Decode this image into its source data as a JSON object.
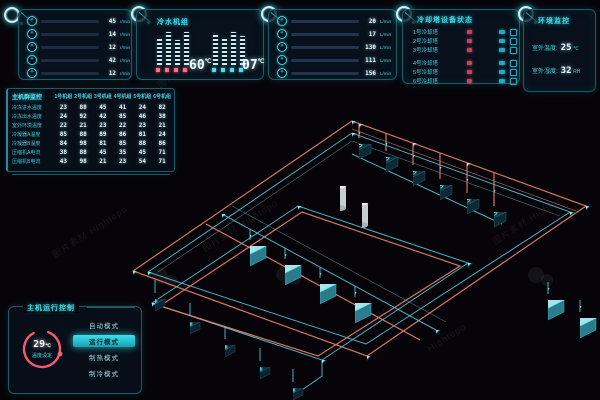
{
  "panels": {
    "pump_metrics": {
      "icon": "fan-icon",
      "rows": [
        {
          "value": "45",
          "unit": "r/min",
          "pct": 82
        },
        {
          "value": "14",
          "unit": "r/min",
          "pct": 60
        },
        {
          "value": "12",
          "unit": "r/min",
          "pct": 26
        },
        {
          "value": "42",
          "unit": "r/min",
          "pct": 63
        },
        {
          "value": "12",
          "unit": "r/min",
          "pct": 35
        }
      ]
    },
    "chilled_water": {
      "title": "冷水机组",
      "left": {
        "value": "60",
        "unit": "℃"
      },
      "right": {
        "value": "07",
        "unit": "℃"
      }
    },
    "flow_metrics": {
      "icon": "fan-icon",
      "rows": [
        {
          "value": "20",
          "unit": "L/min",
          "pct": 10
        },
        {
          "value": "17",
          "unit": "L/min",
          "pct": 13
        },
        {
          "value": "130",
          "unit": "L/min",
          "pct": 62
        },
        {
          "value": "111",
          "unit": "L/min",
          "pct": 52
        },
        {
          "value": "156",
          "unit": "L/min",
          "pct": 75
        }
      ]
    },
    "cooling_tower_status": {
      "title": "冷却塔设备状态",
      "rows": [
        {
          "label": "1号冷却塔"
        },
        {
          "label": "2号冷却塔"
        },
        {
          "label": "3号冷却塔"
        },
        {
          "label": "4号冷却塔"
        },
        {
          "label": "5号冷却塔"
        },
        {
          "label": "6号冷却塔"
        }
      ]
    },
    "environment": {
      "title": "环境监控",
      "rows": [
        {
          "label": "室外温度:",
          "value": "25",
          "unit": "℃"
        },
        {
          "label": "室外湿度:",
          "value": "32",
          "unit": "RH"
        }
      ]
    }
  },
  "host_table": {
    "title": "主机群监控",
    "columns": [
      "1号机组",
      "2号机组",
      "3号机组",
      "4号机组",
      "5号机组",
      "6号机组"
    ],
    "rows": [
      {
        "label": "冷冻进水温度",
        "values": [
          "23",
          "88",
          "45",
          "41",
          "24",
          "82"
        ]
      },
      {
        "label": "冷冻出水温度",
        "values": [
          "24",
          "92",
          "42",
          "85",
          "46",
          "38"
        ]
      },
      {
        "label": "室外环境温度",
        "values": [
          "22",
          "21",
          "23",
          "22",
          "23",
          "21"
        ]
      },
      {
        "label": "冷凝器A温度",
        "values": [
          "85",
          "88",
          "89",
          "86",
          "81",
          "24"
        ]
      },
      {
        "label": "冷凝器B温度",
        "values": [
          "84",
          "98",
          "81",
          "85",
          "88",
          "86"
        ]
      },
      {
        "label": "压缩机A电流",
        "values": [
          "38",
          "88",
          "45",
          "35",
          "45",
          "71"
        ]
      },
      {
        "label": "压缩机B电流",
        "values": [
          "43",
          "98",
          "21",
          "23",
          "54",
          "71"
        ]
      }
    ]
  },
  "control": {
    "title": "主机运行控制",
    "gauge": {
      "value": "29",
      "unit": "℃",
      "label": "温度设定"
    },
    "modes": [
      {
        "label": "自动模式",
        "selected": false
      },
      {
        "label": "运行模式",
        "selected": true
      },
      {
        "label": "制热模式",
        "selected": false
      },
      {
        "label": "制冷模式",
        "selected": false
      }
    ]
  },
  "watermark": {
    "text": "图片素材",
    "brand": "Hightopo"
  },
  "colors": {
    "accent_cyan": "#3fd8e4",
    "accent_pink": "#ff6b81",
    "pipe_orange": "#e8836f",
    "pipe_cyan": "#58cfe0",
    "panel_border": "#1d5a6b",
    "background": "#060409"
  }
}
